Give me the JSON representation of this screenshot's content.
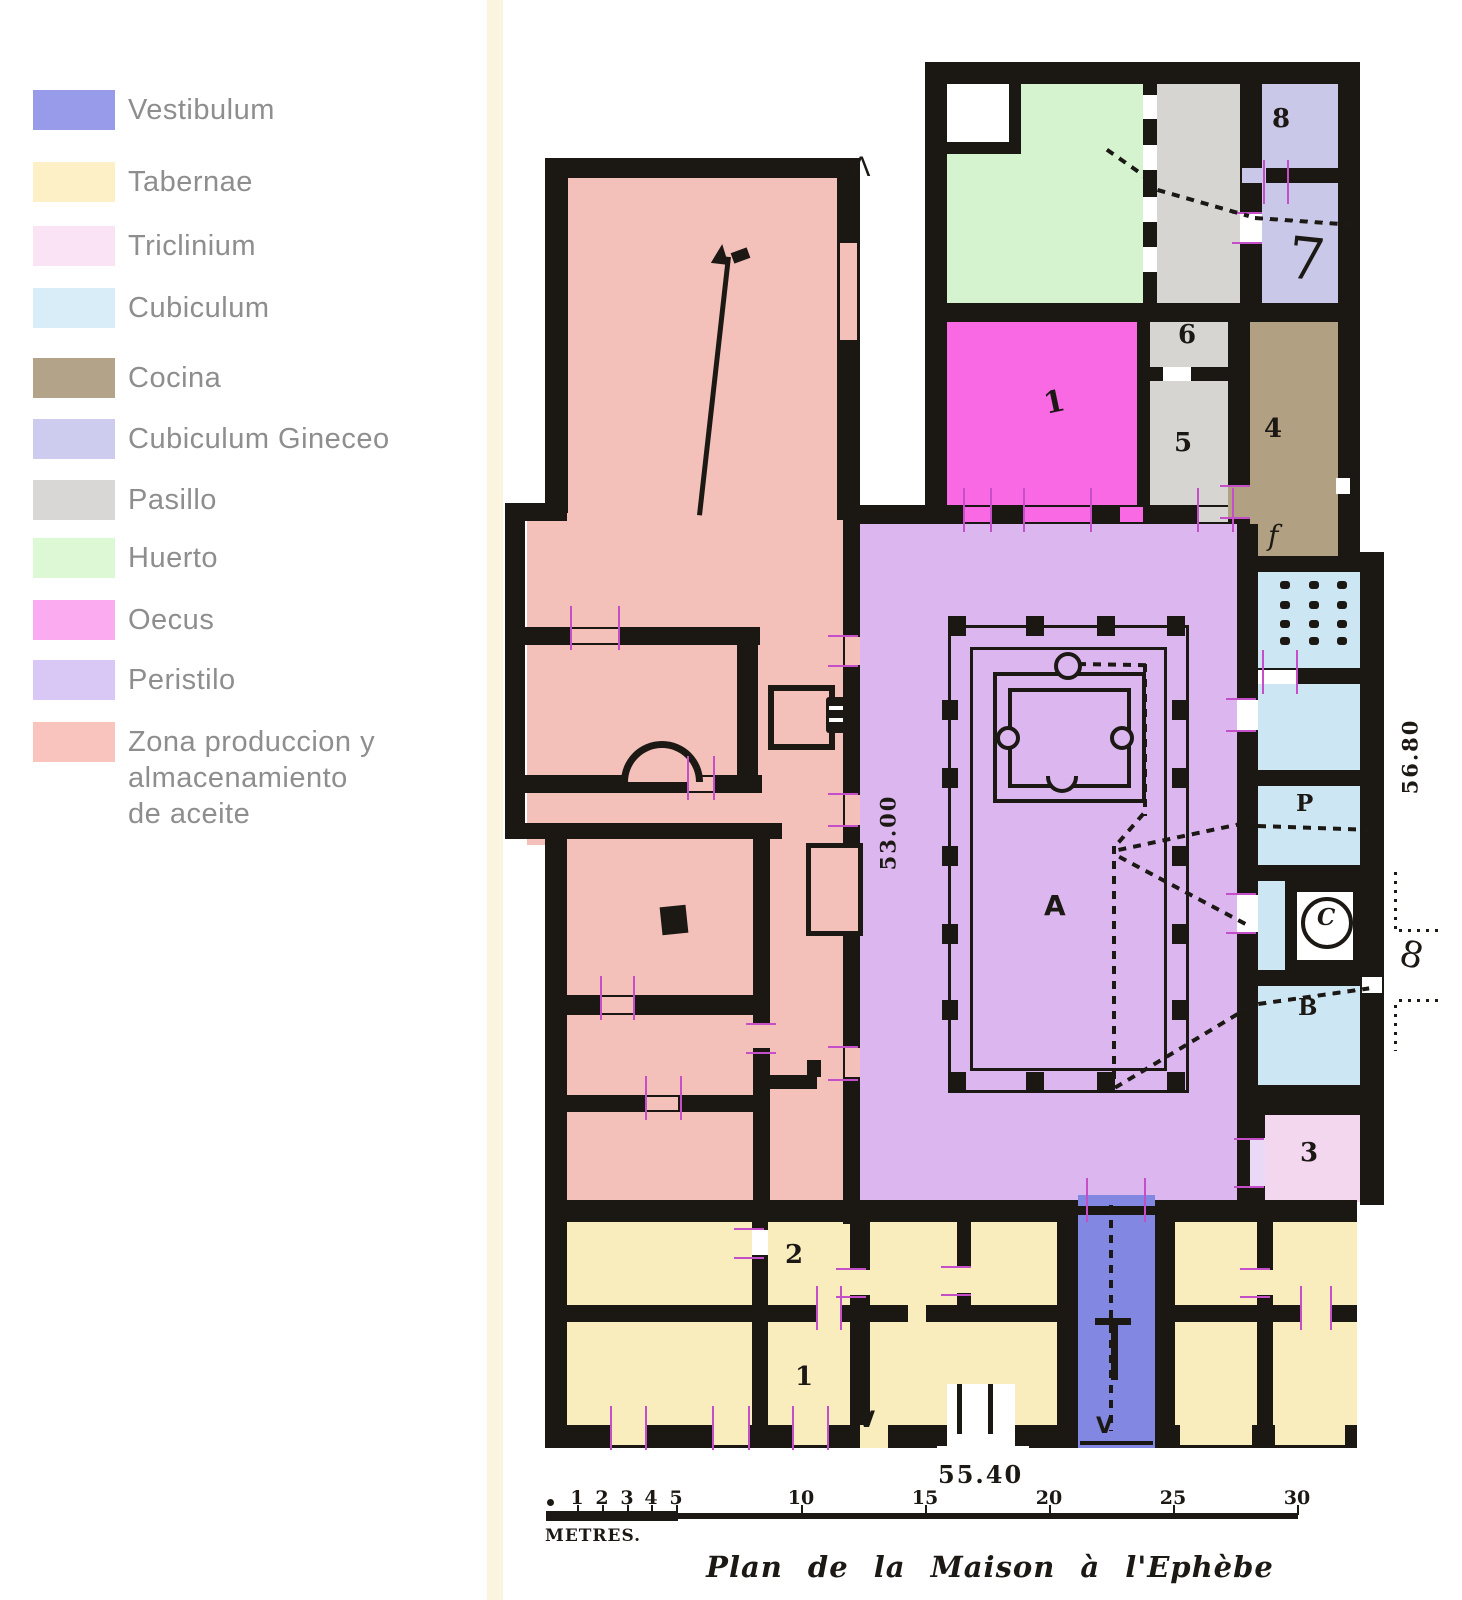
{
  "legend": {
    "items": [
      {
        "label": "Vestibulum",
        "color": "#979be9"
      },
      {
        "label": "Tabernae",
        "color": "#fdf0c6"
      },
      {
        "label": "Triclinium",
        "color": "#f9e3f5"
      },
      {
        "label": "Cubiculum",
        "color": "#d9edf8"
      },
      {
        "label": "Cocina",
        "color": "#b3a489"
      },
      {
        "label": "Cubiculum Gineceo",
        "color": "#cdccee"
      },
      {
        "label": "Pasillo",
        "color": "#d9d7d5"
      },
      {
        "label": "Huerto",
        "color": "#dcf8d5"
      },
      {
        "label": "Oecus",
        "color": "#fbabf0"
      },
      {
        "label": "Peristilo",
        "color": "#d9c7f5"
      },
      {
        "label": "Zona produccion y\nalmacenamiento\nde aceite",
        "color": "#f9c4bd"
      }
    ]
  },
  "plan": {
    "caption": "Plan de la Maison à l'Ephèbe",
    "room_labels": {
      "taberna_lower": "1",
      "taberna_upper": "2",
      "triclinium": "3",
      "cocina": "4",
      "room5": "5",
      "room6": "6",
      "gineceo7": "7",
      "gineceo8": "8",
      "cocina_f": "f",
      "peristyle_a": "A",
      "cubiculum_p": "P",
      "well_c": "C",
      "cubiculum_b": "B",
      "oecus_mark": "1"
    },
    "marks": {
      "north_entrance": "Λ",
      "entrance_left": "V",
      "entrance_vestibule": "V",
      "east_ref": "8"
    },
    "measurements": {
      "west_side": "53.00",
      "east_side": "56.80",
      "south_side": "55.40"
    },
    "scale_bar": {
      "ticks": [
        "1",
        "2",
        "3",
        "4",
        "5",
        "10",
        "15",
        "20",
        "25",
        "30"
      ],
      "unit": "METRES."
    }
  },
  "colors": {
    "plan": {
      "wall": "#1b1712",
      "ink": "#1c1915",
      "salmon": "#f4c1ba",
      "tabernae": "#f9ecbd",
      "peristilo": "#dcb6ef",
      "oecus": "#f969e4",
      "huerto": "#d6f3cf",
      "pasillo": "#d7d5d2",
      "gineceo": "#cac8e9",
      "cocina": "#b2a083",
      "cubiculum": "#cde6f4",
      "triclinium": "#f3d7ee",
      "vestibulum": "#8287e2",
      "tick": "#c44fc8",
      "white": "#ffffff",
      "lightdoor": "#ead9f6",
      "scan_edge": "#fbf4df"
    }
  }
}
